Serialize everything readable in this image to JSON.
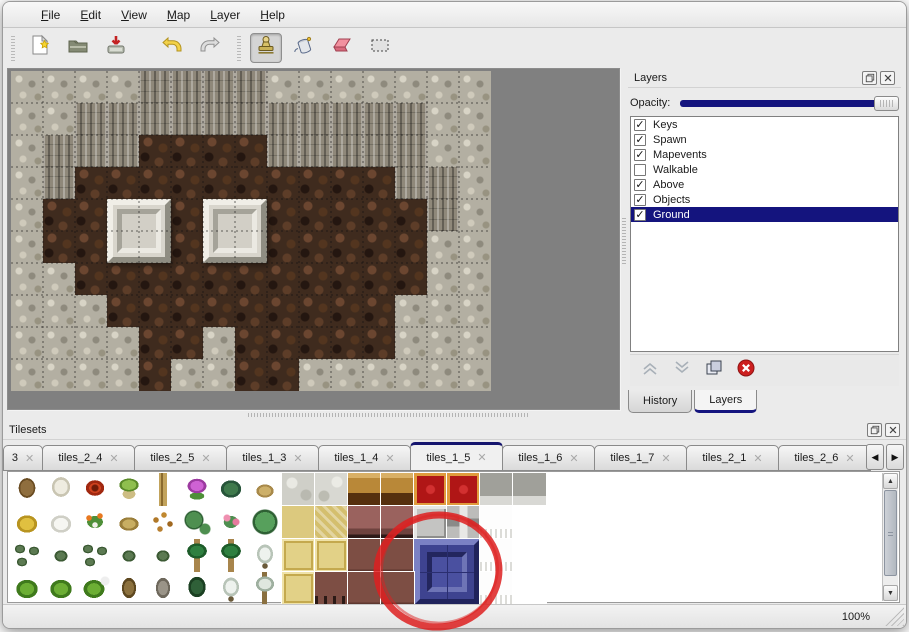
{
  "menu": {
    "items": [
      "File",
      "Edit",
      "View",
      "Map",
      "Layer",
      "Help"
    ]
  },
  "toolbar": {
    "groups": [
      [
        "new-file",
        "open",
        "save"
      ],
      [
        "undo",
        "redo"
      ],
      [
        "stamp",
        "fill",
        "eraser",
        "select"
      ]
    ],
    "active_tool": "stamp"
  },
  "map": {
    "cols": 15,
    "rows": 10,
    "tile_size": 32,
    "legend": {
      "G": "gray-rock",
      "C": "cliff-face",
      "B": "brown-floor"
    },
    "grid": [
      "GGGGCCCCGGGGGGG",
      "GGCCCCCCCCCCCGG",
      "GCCCBBBBCCCCCGG",
      "GCBBBBBBBBBBCCG",
      "GBBBBBBBBBBBBCG",
      "GBBBBBBBBBBBBGG",
      "GGBBBBBBBBBBBGG",
      "GGGBBBBBBBBBGGG",
      "GGGGBBGBBBBBGGG",
      "GGGGBGGBBGGGGGG"
    ],
    "pillars": [
      {
        "col": 3,
        "row": 4
      },
      {
        "col": 6,
        "row": 4
      }
    ]
  },
  "layers_panel": {
    "title": "Layers",
    "opacity_label": "Opacity:",
    "opacity_percent": 100,
    "layers": [
      {
        "name": "Keys",
        "checked": true,
        "selected": false
      },
      {
        "name": "Spawn",
        "checked": true,
        "selected": false
      },
      {
        "name": "Mapevents",
        "checked": true,
        "selected": false
      },
      {
        "name": "Walkable",
        "checked": false,
        "selected": false
      },
      {
        "name": "Above",
        "checked": true,
        "selected": false
      },
      {
        "name": "Objects",
        "checked": true,
        "selected": false
      },
      {
        "name": "Ground",
        "checked": true,
        "selected": true
      }
    ],
    "action_icons": [
      "raise-layer",
      "lower-layer",
      "duplicate-layer",
      "delete-layer"
    ],
    "tabs": [
      {
        "label": "History",
        "active": false
      },
      {
        "label": "Layers",
        "active": true
      }
    ]
  },
  "tilesets_panel": {
    "title": "Tilesets",
    "close_glyph": "✕",
    "tabs": [
      {
        "label": "3",
        "active": false
      },
      {
        "label": "tiles_2_4",
        "active": false
      },
      {
        "label": "tiles_2_5",
        "active": false
      },
      {
        "label": "tiles_1_3",
        "active": false
      },
      {
        "label": "tiles_1_4",
        "active": false
      },
      {
        "label": "tiles_1_5",
        "active": true
      },
      {
        "label": "tiles_1_6",
        "active": false
      },
      {
        "label": "tiles_1_7",
        "active": false
      },
      {
        "label": "tiles_2_1",
        "active": false
      },
      {
        "label": "tiles_2_6",
        "active": false
      }
    ],
    "plant_tiles": [
      [
        "treebare",
        "treewhite",
        "flowerred",
        "stump",
        "trunk",
        "flowerpurple",
        "fern",
        "plantdry"
      ],
      [
        "hay",
        "snowmound",
        "flowerorange",
        "grassdry",
        "leaves",
        "lilypad",
        "flowerpink",
        "lilypadbig"
      ],
      [
        "shrubs",
        "shrub",
        "shrubs",
        "shrub",
        "shrub",
        "palm",
        "palm",
        "pinesnow"
      ],
      [
        "bush",
        "bush",
        "bushsnow",
        "treetwist",
        "treegray",
        "treedark",
        "pinesnow",
        "palmsnow"
      ]
    ],
    "floor_tiles": [
      [
        "cobble",
        "cobble2",
        "wood",
        "wood",
        "carpet",
        "carpet",
        "stone",
        "stone"
      ],
      [
        "tan1",
        "tan2",
        "maroon",
        "maroon",
        "block1",
        "block2",
        "fluff",
        "plain"
      ],
      [
        "tan3",
        "tan3",
        "brown",
        "brown",
        "blue2",
        "",
        "fluff",
        "plain"
      ],
      [
        "tan3",
        "legs",
        "brown",
        "brown",
        "",
        "",
        "fluff",
        "plain"
      ]
    ]
  },
  "icons": {
    "check": "✓",
    "up_arrow": "▲",
    "down_arrow": "▼",
    "left_arrow": "◀",
    "right_arrow": "▶"
  },
  "annotation": {
    "shape": "ellipse",
    "color": "#dd2020",
    "cx": 438,
    "cy": 571,
    "rx": 61,
    "ry": 56,
    "stroke_width": 7
  },
  "status_bar": {
    "zoom": "100%"
  },
  "colors": {
    "accent_navy": "#14147e",
    "map_backdrop": "#808080",
    "window_bg": "#ebebeb"
  }
}
